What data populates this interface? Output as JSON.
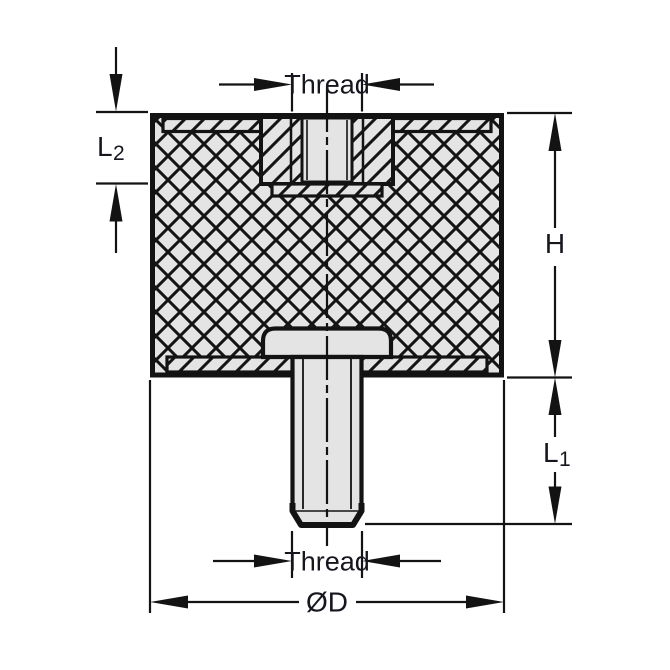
{
  "diagram": {
    "labels": {
      "thread_top": "Thread",
      "l2_main": "L",
      "l2_sub": "2",
      "h": "H",
      "l1_main": "L",
      "l1_sub": "1",
      "thread_bottom": "Thread",
      "diameter": "ØD"
    },
    "colors": {
      "line": "#131313",
      "metal_fill": "#e4e4e4",
      "text": "#16161f",
      "background": "#ffffff"
    }
  }
}
